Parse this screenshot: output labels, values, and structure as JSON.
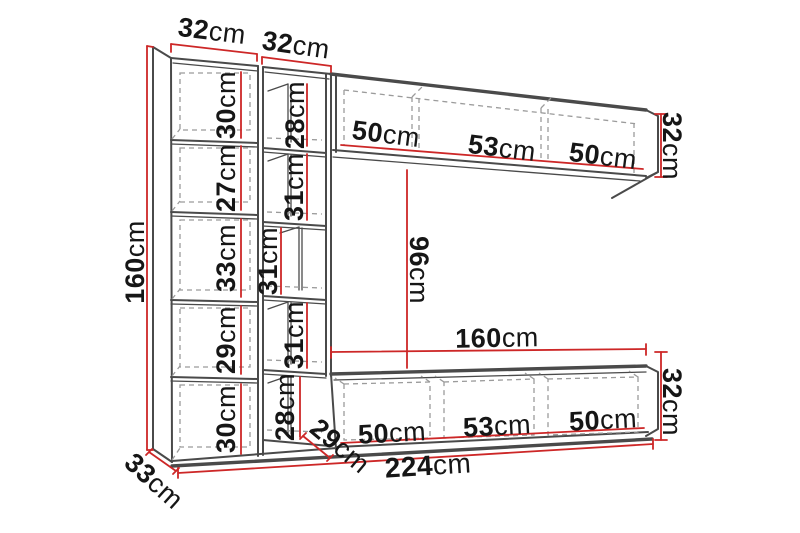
{
  "colors": {
    "outline": "#4a4a4a",
    "hidden_line": "#9b9b9b",
    "dimension_line": "#cd2727",
    "label_text": "#161616",
    "background": "#ffffff"
  },
  "diagram": {
    "kind": "furniture-wall-unit-dimension-diagram",
    "measure_unit": "cm",
    "overall": {
      "total_width_cm": 224,
      "total_height_cm": 160,
      "tall_cabinet_depth_cm": 33,
      "bench_depth_cm": 29,
      "niche_height_cm": 96
    },
    "dims": {
      "col_a_width": {
        "v": "32",
        "u": "cm"
      },
      "col_b_width": {
        "v": "32",
        "u": "cm"
      },
      "col_a_shelves": [
        {
          "v": "30",
          "u": "cm"
        },
        {
          "v": "27",
          "u": "cm"
        },
        {
          "v": "33",
          "u": "cm"
        },
        {
          "v": "29",
          "u": "cm"
        },
        {
          "v": "30",
          "u": "cm"
        }
      ],
      "col_b_shelves": [
        {
          "v": "28",
          "u": "cm"
        },
        {
          "v": "31",
          "u": "cm"
        },
        {
          "v": "31",
          "u": "cm"
        },
        {
          "v": "31",
          "u": "cm"
        },
        {
          "v": "28",
          "u": "cm"
        }
      ],
      "total_height": {
        "v": "160",
        "u": "cm"
      },
      "side_depth": {
        "v": "33",
        "u": "cm"
      },
      "top_cabinet_sections": [
        {
          "v": "50",
          "u": "cm"
        },
        {
          "v": "53",
          "u": "cm"
        },
        {
          "v": "50",
          "u": "cm"
        }
      ],
      "top_cabinet_height": {
        "v": "32",
        "u": "cm"
      },
      "niche_height": {
        "v": "96",
        "u": "cm"
      },
      "bench_length": {
        "v": "160",
        "u": "cm"
      },
      "bench_sections": [
        {
          "v": "50",
          "u": "cm"
        },
        {
          "v": "53",
          "u": "cm"
        },
        {
          "v": "50",
          "u": "cm"
        }
      ],
      "bench_height": {
        "v": "32",
        "u": "cm"
      },
      "bench_depth": {
        "v": "29",
        "u": "cm"
      },
      "total_width": {
        "v": "224",
        "u": "cm"
      }
    }
  }
}
